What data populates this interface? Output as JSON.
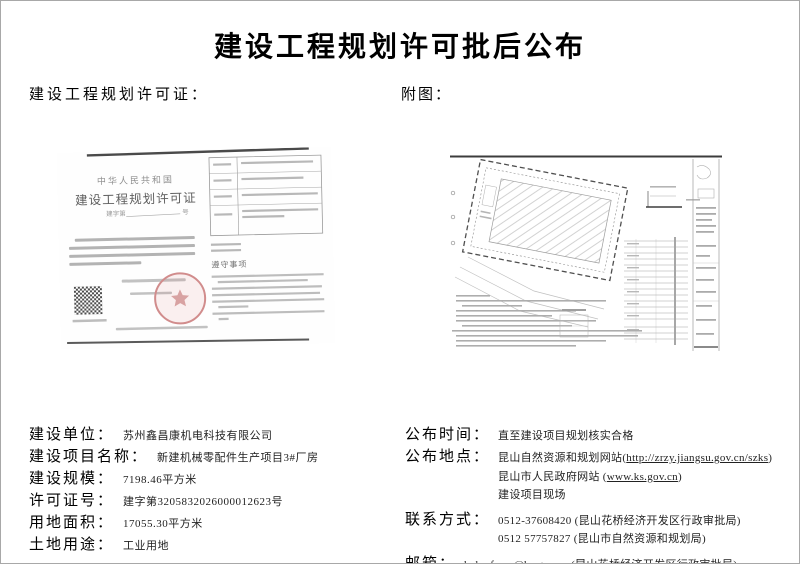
{
  "page": {
    "title": "建设工程规划许可批后公布"
  },
  "section_labels": {
    "permit": "建设工程规划许可证：",
    "attachment": "附图："
  },
  "certificate": {
    "country": "中华人民共和国",
    "title": "建设工程规划许可证",
    "number_prefix": "建字第",
    "number_suffix": "号",
    "compliance_title": "遵守事项"
  },
  "info_left": {
    "rows": [
      {
        "label": "建设单位：",
        "value": "苏州鑫昌康机电科技有限公司"
      },
      {
        "label": "建设项目名称：",
        "value": "新建机械零配件生产项目3#厂房"
      },
      {
        "label": "建设规模：",
        "value": "7198.46平方米"
      },
      {
        "label": "许可证号：",
        "value": "建字第3205832026000012623号"
      },
      {
        "label": "用地面积：",
        "value": "17055.30平方米"
      },
      {
        "label": "土地用途：",
        "value": "工业用地"
      }
    ]
  },
  "info_right": {
    "publish_time": {
      "label": "公布时间：",
      "value": "直至建设项目规划核实合格"
    },
    "publish_place": {
      "label": "公布地点：",
      "line1_prefix": "昆山自然资源和规划网站(",
      "line1_link": "http://zrzy.jiangsu.gov.cn/szks",
      "line1_suffix": ")",
      "line2_prefix": "昆山市人民政府网站 (",
      "line2_link": "www.ks.gov.cn",
      "line2_suffix": ")",
      "line3": "建设项目现场"
    },
    "contact": {
      "label": "联系方式：",
      "line1": "0512-37608420 (昆山花桥经济开发区行政审批局)",
      "line2": "0512 57757827 (昆山市自然资源和规划局)"
    },
    "email": {
      "label": "邮箱：",
      "address": "hqbmfwzx@ks.gov.cn",
      "note": " (昆山花桥经济开发区行政审批局)"
    }
  }
}
